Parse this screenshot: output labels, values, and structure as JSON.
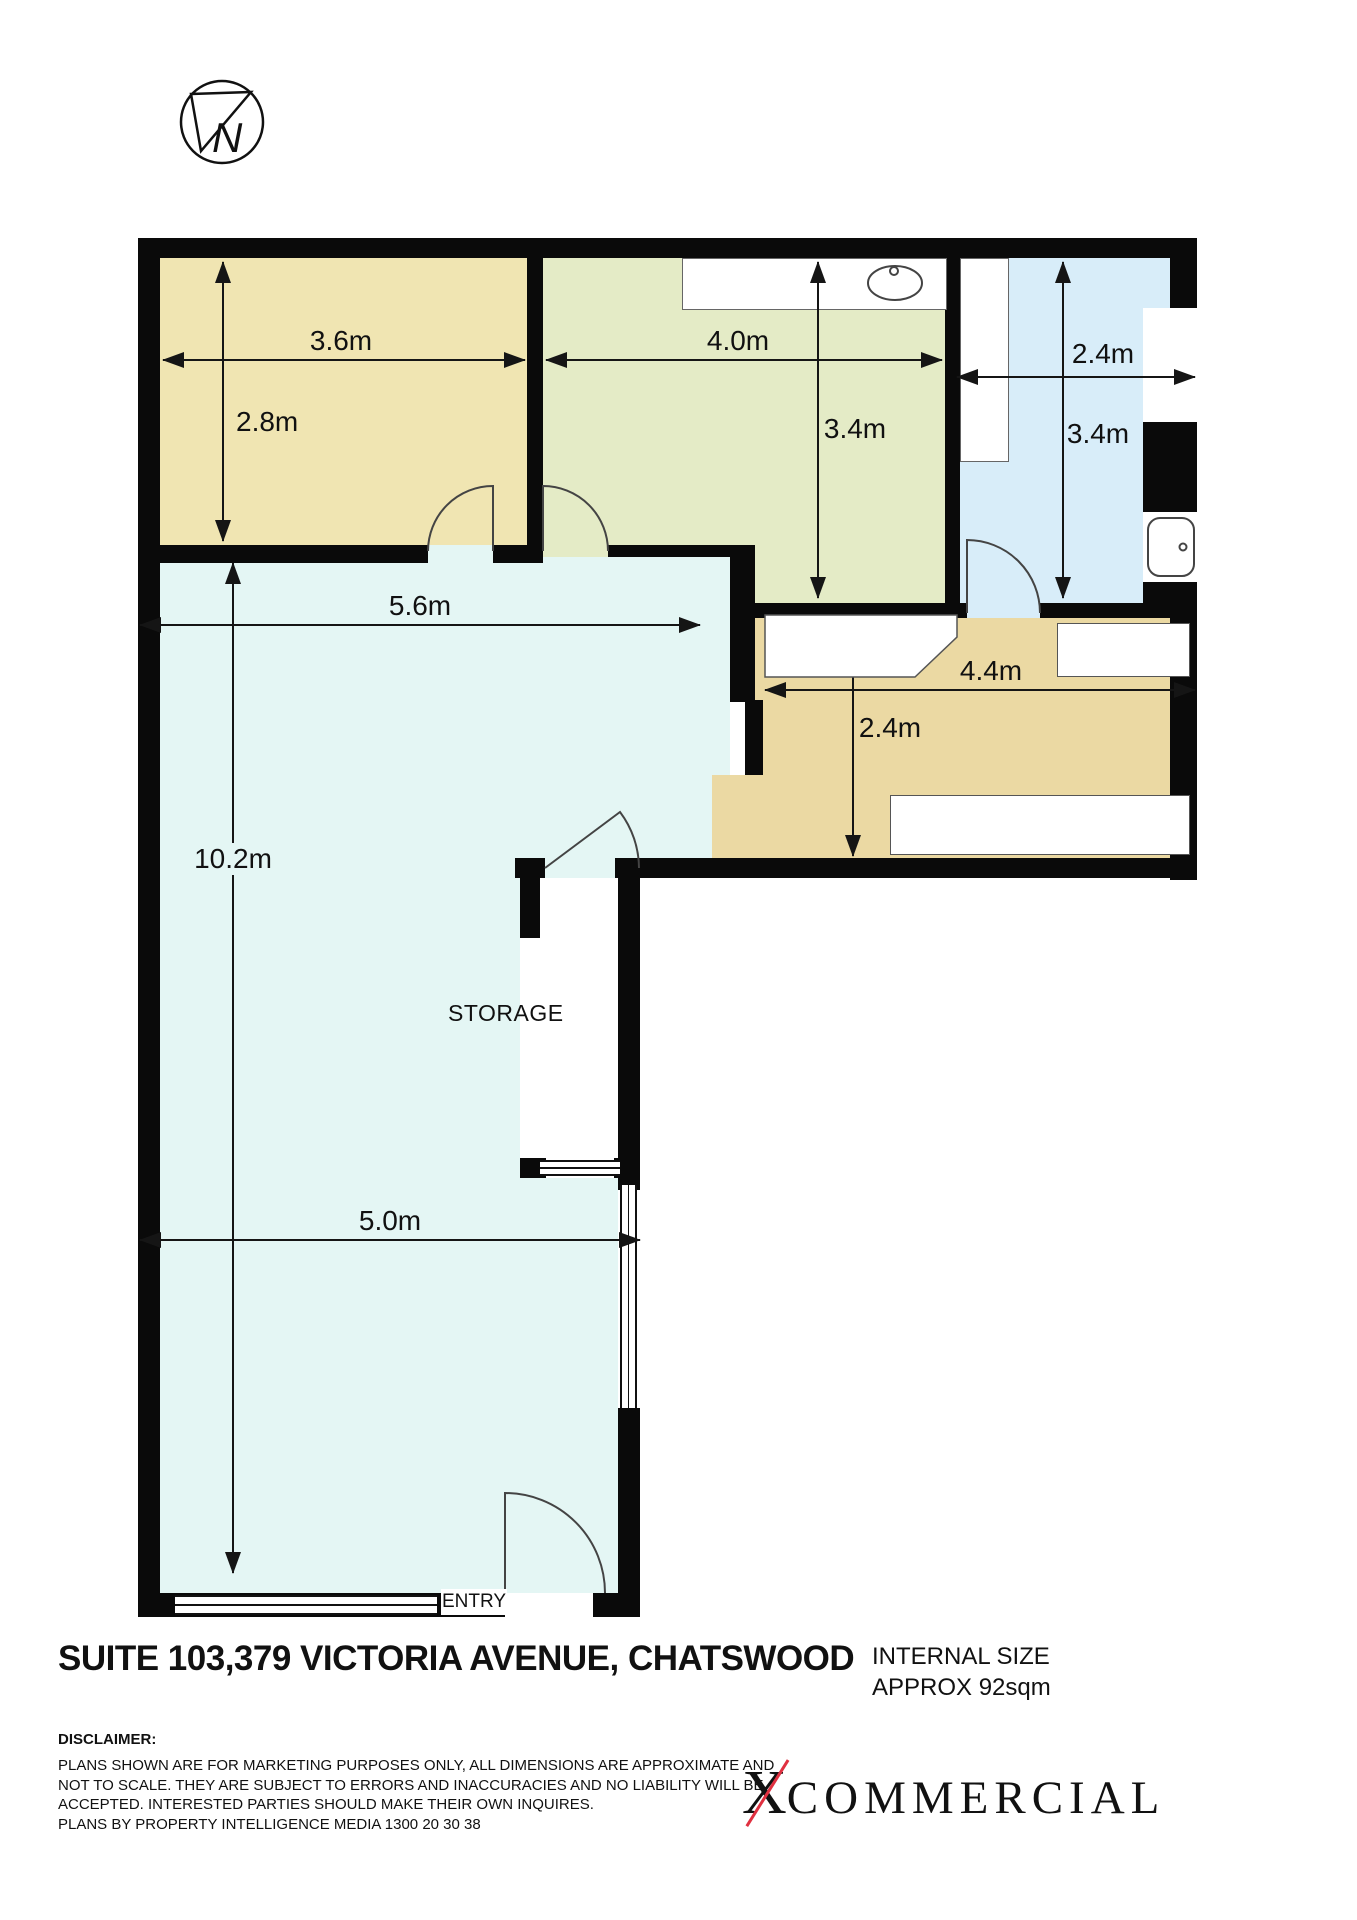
{
  "compass": {
    "letter": "N"
  },
  "plan": {
    "dimensions": {
      "room1_width": "3.6m",
      "room1_depth": "2.8m",
      "room2_width": "4.0m",
      "room2_depth": "3.4m",
      "room3_width": "2.4m",
      "room3_depth": "3.4m",
      "main_width": "5.6m",
      "hall_width": "4.4m",
      "hall_depth": "2.4m",
      "main_depth": "10.2m",
      "entry_width": "5.0m"
    },
    "room_labels": {
      "storage": "STORAGE",
      "entry": "ENTRY"
    }
  },
  "footer": {
    "title": "SUITE 103,379 VICTORIA AVENUE, CHATSWOOD",
    "internal_size": {
      "line1": "INTERNAL SIZE",
      "line2": "APPROX 92sqm"
    },
    "disclaimer": {
      "heading": "DISCLAIMER:",
      "lines": [
        "PLANS SHOWN ARE FOR MARKETING PURPOSES ONLY, ALL DIMENSIONS ARE APPROXIMATE AND",
        "NOT TO SCALE. THEY ARE SUBJECT TO ERRORS AND INACCURACIES AND NO LIABILITY WILL BE",
        "ACCEPTED. INTERESTED PARTIES SHOULD MAKE THEIR OWN INQUIRES.",
        "PLANS BY PROPERTY INTELLIGENCE MEDIA 1300 20 30 38"
      ]
    },
    "logo": {
      "x": "X",
      "rest": "COMMERCIAL"
    }
  },
  "colors": {
    "room_tan": "#F0E5B2",
    "room_green": "#E4EBC6",
    "room_blue": "#D8EDF9",
    "room_main": "#E4F6F4",
    "hall_tan": "#EBD9A3",
    "wall": "#0A0A0A",
    "logo_slash": "#E03040"
  }
}
